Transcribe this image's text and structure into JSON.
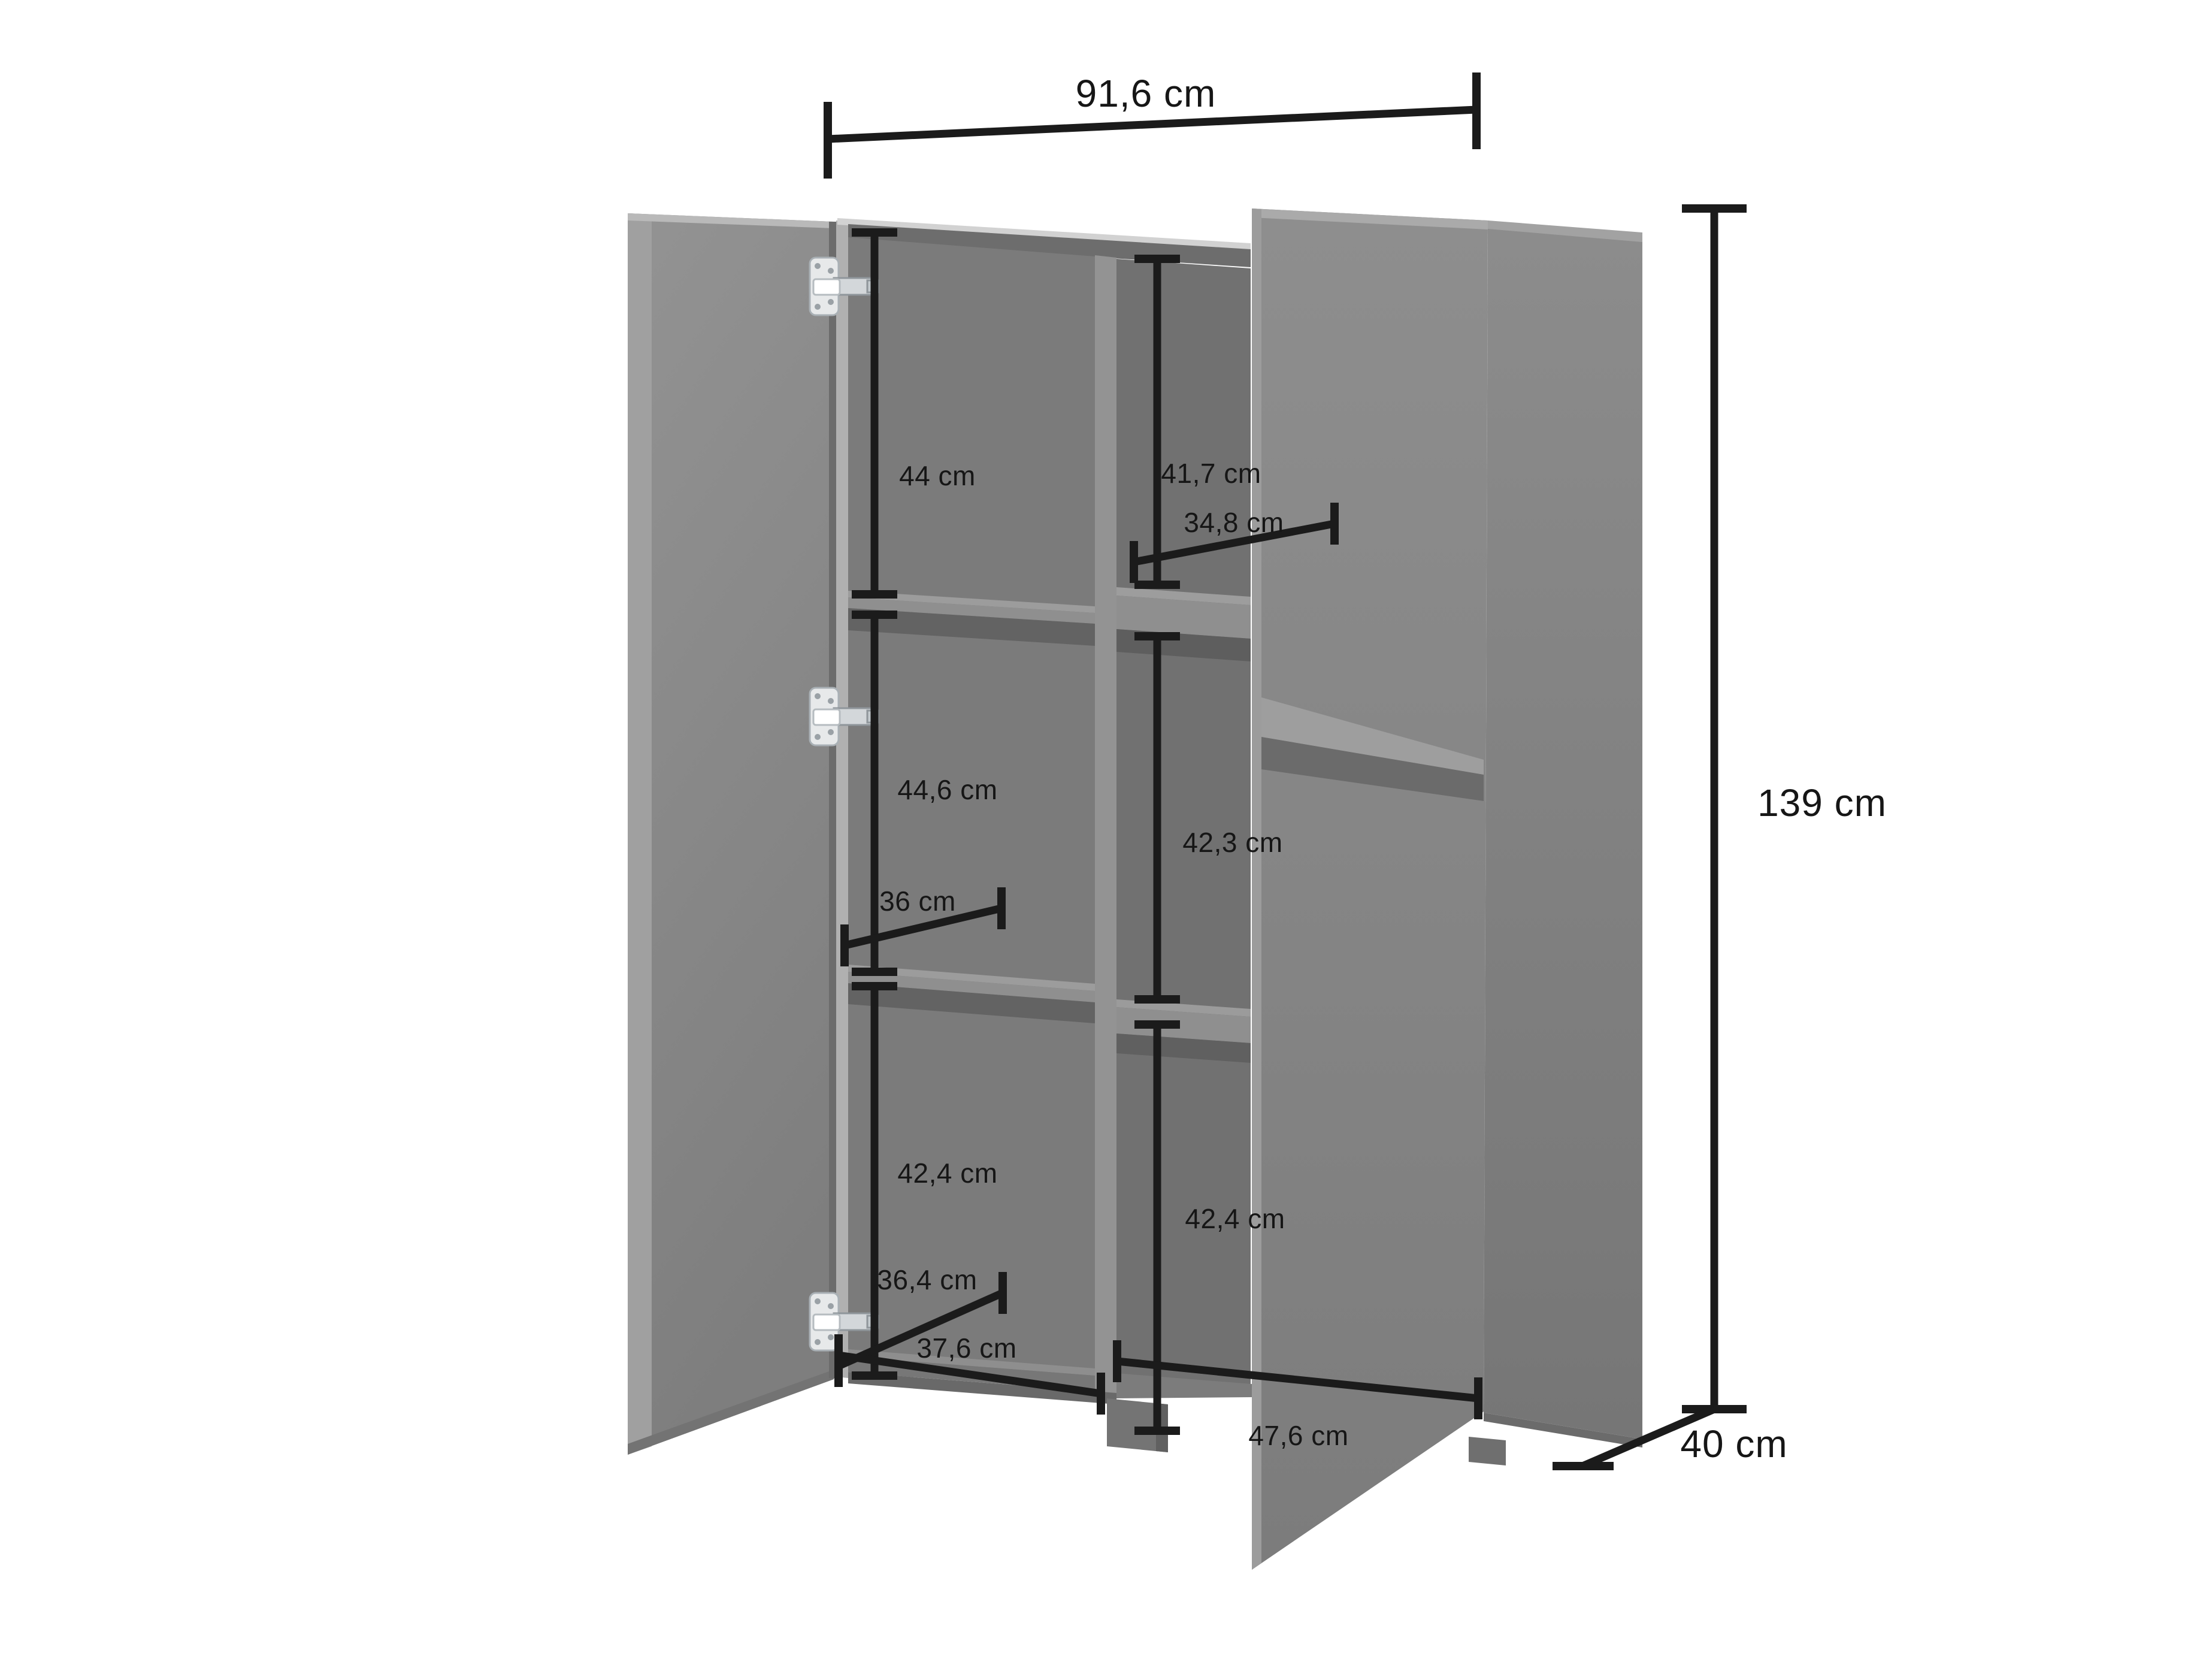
{
  "diagram": {
    "type": "furniture-dimension-diagram",
    "subject": "two-door cabinet with open doors, interior shelves and hinges",
    "unit": "cm",
    "colors": {
      "background": "#ffffff",
      "cabinet_gray": "#878787",
      "cabinet_interior_gray": "#787878",
      "cabinet_light_edge": "#b3b3b3",
      "dimension_line": "#1b1b1b",
      "hinge_metal": "#e8eaec"
    },
    "overall": {
      "width": "91,6 cm",
      "height": "139 cm",
      "depth": "40 cm"
    },
    "labels": {
      "width": "91,6 cm",
      "height": "139 cm",
      "depth": "40 cm",
      "left_top_compartment": "44 cm",
      "left_middle_compartment": "44,6 cm",
      "left_bottom_compartment": "42,4 cm",
      "right_top_compartment": "41,7 cm",
      "right_middle_compartment": "42,3 cm",
      "right_bottom_compartment": "42,4 cm",
      "top_shelf_depth": "34,8 cm",
      "middle_shelf_depth": "36 cm",
      "bottom_shelf_depth": "36,4 cm",
      "bottom_left_interior_width": "37,6 cm",
      "bottom_right_interior_width": "47,6 cm"
    },
    "hinge_count": 3
  }
}
